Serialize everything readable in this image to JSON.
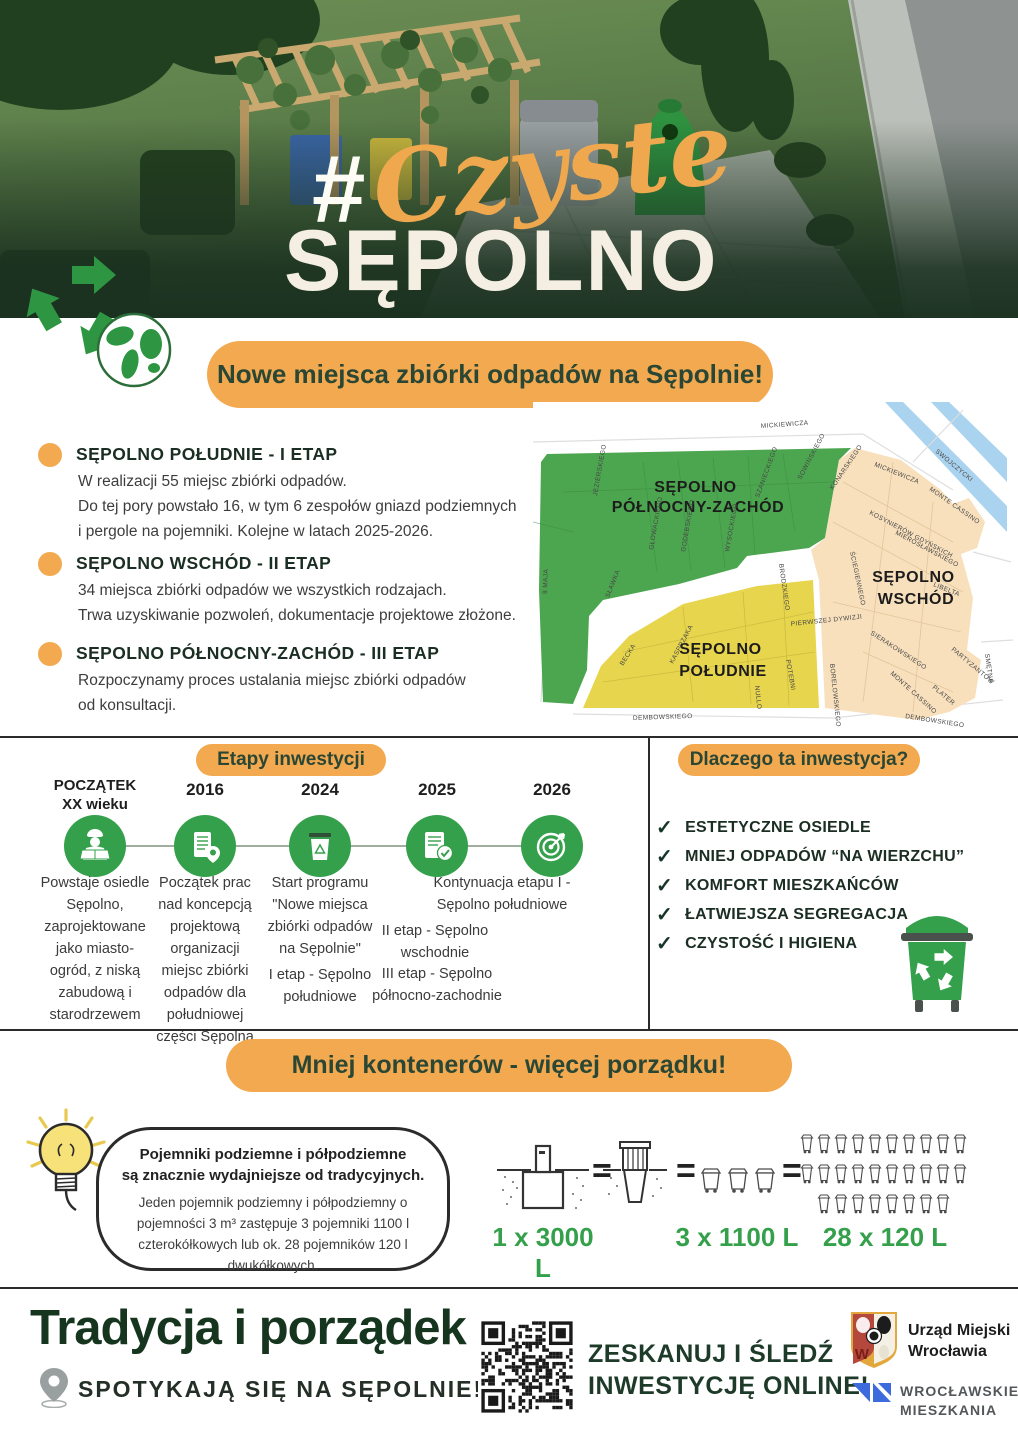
{
  "colors": {
    "accent_orange": "#F3A94F",
    "green": "#35A04B",
    "dark_green": "#1E3A28",
    "map_green": "#4CA64F",
    "map_yellow": "#E7D54D",
    "map_beige": "#F8E0BD",
    "map_blue": "#A9D3EE"
  },
  "header": {
    "hashtag": "#",
    "title_script": "Czyste",
    "title_main": "SĘPOLNO",
    "banner": "Nowe miejsca zbiórki odpadów na Sępolnie!"
  },
  "stages": [
    {
      "heading": "SĘPOLNO POŁUDNIE - I ETAP",
      "body": "W realizacji 55 miejsc zbiórki odpadów.\nDo tej pory powstało 16, w tym 6 zespołów gniazd podziemnych\ni pergole na pojemniki. Kolejne w latach 2025-2026."
    },
    {
      "heading": "SĘPOLNO WSCHÓD - II ETAP",
      "body": "34 miejsca zbiórki odpadów we wszystkich rodzajach.\nTrwa uzyskiwanie pozwoleń, dokumentacje projektowe złożone."
    },
    {
      "heading": "SĘPOLNO PÓŁNOCNY-ZACHÓD - III ETAP",
      "body": "Rozpoczynamy proces ustalania miejsc zbiórki odpadów\nod konsultacji."
    }
  ],
  "map": {
    "regions": [
      {
        "line1": "SĘPOLNO",
        "line2": "PÓŁNOCNY-ZACHÓD"
      },
      {
        "line1": "SĘPOLNO",
        "line2": "WSCHÓD"
      },
      {
        "line1": "SĘPOLNO",
        "line2": "POŁUDNIE"
      }
    ],
    "streets": [
      {
        "label": "MICKIEWICZA",
        "x": 228,
        "y": 26,
        "r": -4
      },
      {
        "label": "SWOJCZYCKI",
        "x": 402,
        "y": 50,
        "r": 40
      },
      {
        "label": "MICKIEWICZA",
        "x": 341,
        "y": 64,
        "r": 22
      },
      {
        "label": "MONTE CASSINO",
        "x": 396,
        "y": 88,
        "r": 35
      },
      {
        "label": "KOSYNIERÓW GDYŃSKICH",
        "x": 336,
        "y": 112,
        "r": 28
      },
      {
        "label": "MIEROSŁAWSKIEGO",
        "x": 362,
        "y": 132,
        "r": 28
      },
      {
        "label": "ŚCIEGIENNEGO",
        "x": 317,
        "y": 150,
        "r": 78
      },
      {
        "label": "LIBELTA",
        "x": 400,
        "y": 184,
        "r": 22
      },
      {
        "label": "SMĘTNA",
        "x": 452,
        "y": 252,
        "r": 82
      },
      {
        "label": "PARTYZANTÓW",
        "x": 418,
        "y": 248,
        "r": 40
      },
      {
        "label": "SIERAKOWSKIEGO",
        "x": 337,
        "y": 232,
        "r": 33
      },
      {
        "label": "MONTE CASSINO",
        "x": 357,
        "y": 272,
        "r": 42
      },
      {
        "label": "PLATER",
        "x": 399,
        "y": 286,
        "r": 40
      },
      {
        "label": "DEMBOWSKIEGO",
        "x": 100,
        "y": 318,
        "r": -2
      },
      {
        "label": "DEMBOWSKIEGO",
        "x": 372,
        "y": 316,
        "r": 9
      },
      {
        "label": "BORELOWSKIEGO",
        "x": 297,
        "y": 262,
        "r": 84
      },
      {
        "label": "POTEBNI",
        "x": 253,
        "y": 258,
        "r": 80
      },
      {
        "label": "NULLO",
        "x": 222,
        "y": 284,
        "r": 84
      },
      {
        "label": "PIERWSZEJ DYWIZJI",
        "x": 258,
        "y": 224,
        "r": -6
      },
      {
        "label": "KASPRZAKA",
        "x": 140,
        "y": 262,
        "r": -62
      },
      {
        "label": "BECKA",
        "x": 90,
        "y": 264,
        "r": -58
      },
      {
        "label": "SŁAWKA",
        "x": 76,
        "y": 196,
        "r": -68
      },
      {
        "label": "8 MAJA",
        "x": 14,
        "y": 192,
        "r": -88
      },
      {
        "label": "JEZIERSKIEGO",
        "x": 64,
        "y": 94,
        "r": -80
      },
      {
        "label": "GŁOWACKIEGO",
        "x": 120,
        "y": 148,
        "r": -80
      },
      {
        "label": "GODEBSKIEGO",
        "x": 152,
        "y": 150,
        "r": -80
      },
      {
        "label": "WYSOCKIEGO",
        "x": 196,
        "y": 150,
        "r": -80
      },
      {
        "label": "SZANIECKIEGO",
        "x": 226,
        "y": 96,
        "r": -70
      },
      {
        "label": "SOWIŃSKIEGO",
        "x": 268,
        "y": 78,
        "r": -62
      },
      {
        "label": "KONARSKIEGO",
        "x": 300,
        "y": 88,
        "r": -56
      },
      {
        "label": "BRODZKIEGO",
        "x": 246,
        "y": 162,
        "r": 82
      }
    ]
  },
  "timeline": {
    "title": "Etapy inwestycji",
    "milestones": [
      {
        "year": "POCZĄTEK\nXX wieku",
        "icon": "construction-worker-icon",
        "text": "Powstaje osiedle\nSępolno,\nzaprojektowane\njako miasto-\nogród, z niską\nzabudową i\nstarodrzewem"
      },
      {
        "year": "2016",
        "icon": "document-location-icon",
        "text": "Początek prac\nnad koncepcją\nprojektową\norganizacji\nmiejsc zbiórki\nodpadów dla\npołudniowej\nczęści Sępolna"
      },
      {
        "year": "2024",
        "icon": "waste-bin-icon",
        "text": "Start programu\n\"Nowe miejsca\nzbiórki odpadów\nna Sępolnie\"",
        "text2": "I etap - Sępolno\npołudniowe"
      },
      {
        "year": "2025",
        "icon": "checklist-icon",
        "text": "Kontynuacja etapu I -\nSępolno południowe",
        "text2": "II etap - Sępolno\nwschodnie",
        "text3": "III etap - Sępolno\npółnocno-zachodnie"
      },
      {
        "year": "2026",
        "icon": "target-icon"
      }
    ]
  },
  "why": {
    "title": "Dlaczego ta inwestycja?",
    "check": "✓",
    "items": [
      "ESTETYCZNE OSIEDLE",
      "MNIEJ ODPADÓW “NA WIERZCHU”",
      "KOMFORT MIESZKAŃCÓW",
      "ŁATWIEJSZA SEGREGACJA",
      "CZYSTOŚĆ I HIGIENA"
    ]
  },
  "less": {
    "title": "Mniej kontenerów - więcej porządku!",
    "tip_bold": "Pojemniki podziemne i półpodziemne\nsą znacznie wydajniejsze od tradycyjnych.",
    "tip_body": "Jeden pojemnik podziemny i półpodziemny o pojemności 3 m³ zastępuje 3 pojemniki 1100 l czterokółkowych lub ok. 28 pojemników 120 l dwukółkowych.",
    "equals": "=",
    "items": [
      {
        "label": "1 x 3000 L",
        "icon": "underground-container-icon",
        "count": 1
      },
      {
        "label": "3 x 1100 L",
        "icon": "bin-1100l-icon",
        "count": 3
      },
      {
        "label": "28 x 120 L",
        "icon": "bin-120l-icon",
        "count": 28,
        "rows": [
          10,
          10,
          8
        ]
      }
    ]
  },
  "footer": {
    "headline": "Tradycja i porządek",
    "subline": "SPOTYKAJĄ SIĘ NA SĘPOLNIE!",
    "scan": "ZESKANUJ I ŚLEDŹ\nINWESTYCJĘ ONLINE!",
    "crest_letter": "W",
    "logo_city": "Urząd Miejski\nWrocławia",
    "logo_wm": "WROCŁAWSKIE\nMIESZKANIA"
  }
}
